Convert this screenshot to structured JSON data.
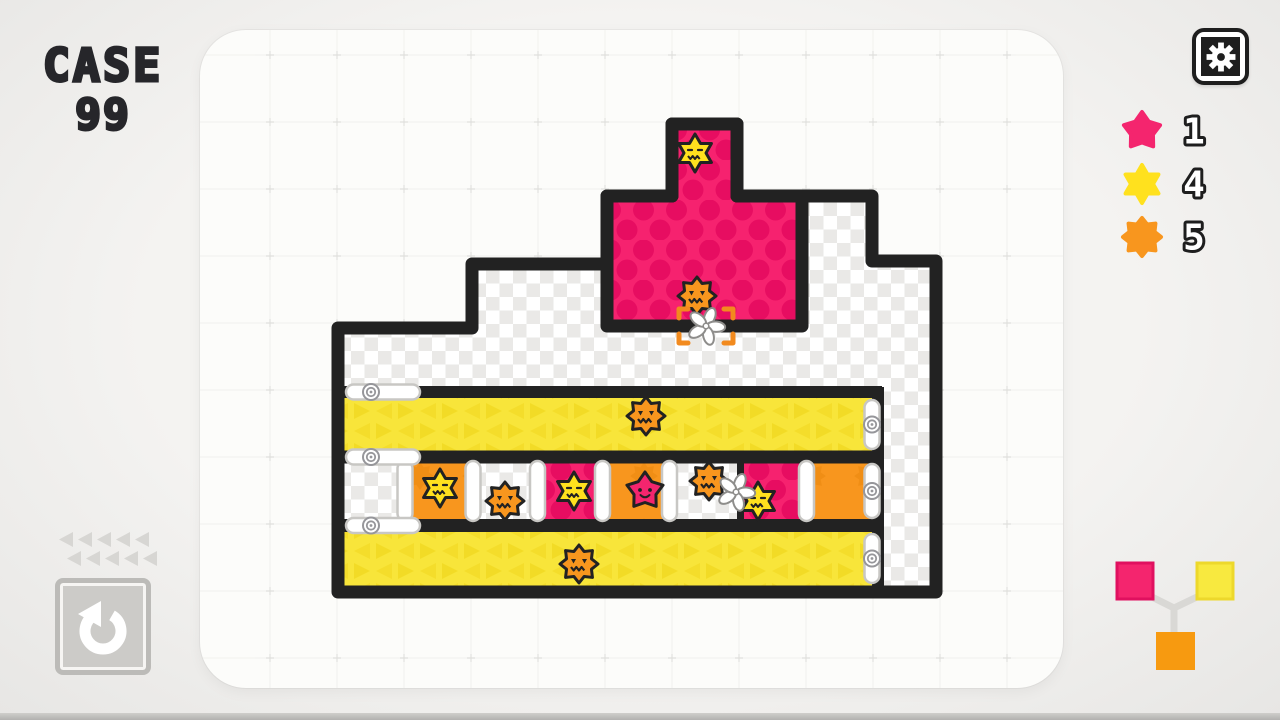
{
  "title": {
    "line1": "CASE",
    "line2": "99"
  },
  "hud": {
    "legend": [
      {
        "shape": "pink-star",
        "count": "1"
      },
      {
        "shape": "yellow-star",
        "count": "4"
      },
      {
        "shape": "orange-burst",
        "count": "5"
      }
    ],
    "move_pips": {
      "rows": 2,
      "cols": 5
    },
    "mix_diagram": {
      "input1": "#F4256E",
      "input2": "#F8E93F",
      "output": "#F79A10"
    }
  },
  "colors": {
    "ink": "#222222",
    "pink": "#F6226F",
    "pink_dot": "#E70D61",
    "yellow": "#F8E53A",
    "yellow_tri": "#EDD215",
    "orange": "#F8961E",
    "orange_dark": "#E8850C",
    "checker": "#EAE9E7",
    "creature_yellow": "#FFE11E",
    "creature_pink": "#F4256E",
    "creature_orange": "#F8961E",
    "capsule_stroke": "#C8C7C4",
    "screw": "#96969A",
    "fan_stroke": "#8E8D8B",
    "bracket": "#F28A1E",
    "grid_line": "#9a9a95",
    "ui_gray": "#D7D6D3",
    "mix_line": "#D9D8D5",
    "mix_border1": "#E0105F",
    "mix_border2": "#EDD82B"
  },
  "board": {
    "grid": {
      "x0": 270,
      "y0": 55,
      "step": 67,
      "x_count": 12,
      "y_count": 10
    },
    "panel_clip": {
      "x": 200,
      "y": 30,
      "w": 863,
      "h": 658,
      "r": 46
    },
    "outline_path": "M338,592 V328 H472 V264 H607 V196 H672 V124 H737 V196 H872 V261 H936 V592 Z",
    "pink_room_path": "M607,196 H672 V124 H737 V196 H802 V326 H607 Z",
    "rows": {
      "x1": 344,
      "x2": 878,
      "top_y": 392,
      "div1_y": 457,
      "div2_y": 525.5,
      "right_wall_x": 878,
      "right_wall_y1": 387,
      "right_wall_y2": 592,
      "row1": {
        "y": 390,
        "h": 67
      },
      "row3": {
        "y": 523,
        "h": 69
      },
      "cell_y": 457,
      "cell_h": 68,
      "cells": [
        {
          "x1": 344,
          "x2": 405,
          "type": "checker"
        },
        {
          "x1": 405,
          "x2": 473,
          "type": "orange"
        },
        {
          "x1": 473,
          "x2": 537.5,
          "type": "checker"
        },
        {
          "x1": 537.5,
          "x2": 602.5,
          "type": "pink"
        },
        {
          "x1": 602.5,
          "x2": 669.5,
          "type": "orange"
        },
        {
          "x1": 669.5,
          "x2": 740.5,
          "type": "checker"
        },
        {
          "x1": 740.5,
          "x2": 806.5,
          "type": "pink"
        },
        {
          "x1": 806.5,
          "x2": 878,
          "type": "orange"
        }
      ],
      "rollers_x": [
        405,
        473,
        537.5,
        602.5,
        669.5,
        806.5
      ],
      "thin_divider_x": 740.5
    },
    "left_bolts_y": [
      392,
      457,
      525.5
    ],
    "right_capsule_x": 872,
    "right_capsules": [
      {
        "y1": 400,
        "y2": 449
      },
      {
        "y1": 464,
        "y2": 518
      },
      {
        "y1": 534,
        "y2": 583
      }
    ],
    "creatures": [
      {
        "type": "yellow-star",
        "x": 695,
        "y": 153
      },
      {
        "type": "orange-burst",
        "x": 697,
        "y": 296
      },
      {
        "type": "orange-burst",
        "x": 646,
        "y": 416
      },
      {
        "type": "yellow-star",
        "x": 440,
        "y": 488
      },
      {
        "type": "orange-burst",
        "x": 505,
        "y": 501
      },
      {
        "type": "yellow-star",
        "x": 574,
        "y": 491
      },
      {
        "type": "pink-star",
        "x": 645,
        "y": 491
      },
      {
        "type": "orange-burst",
        "x": 709,
        "y": 481
      },
      {
        "type": "yellow-star",
        "x": 758,
        "y": 501
      },
      {
        "type": "orange-burst",
        "x": 579,
        "y": 564
      }
    ],
    "fans": [
      {
        "x": 706,
        "y": 326,
        "selected": true
      },
      {
        "x": 736,
        "y": 492,
        "selected": false
      }
    ]
  }
}
